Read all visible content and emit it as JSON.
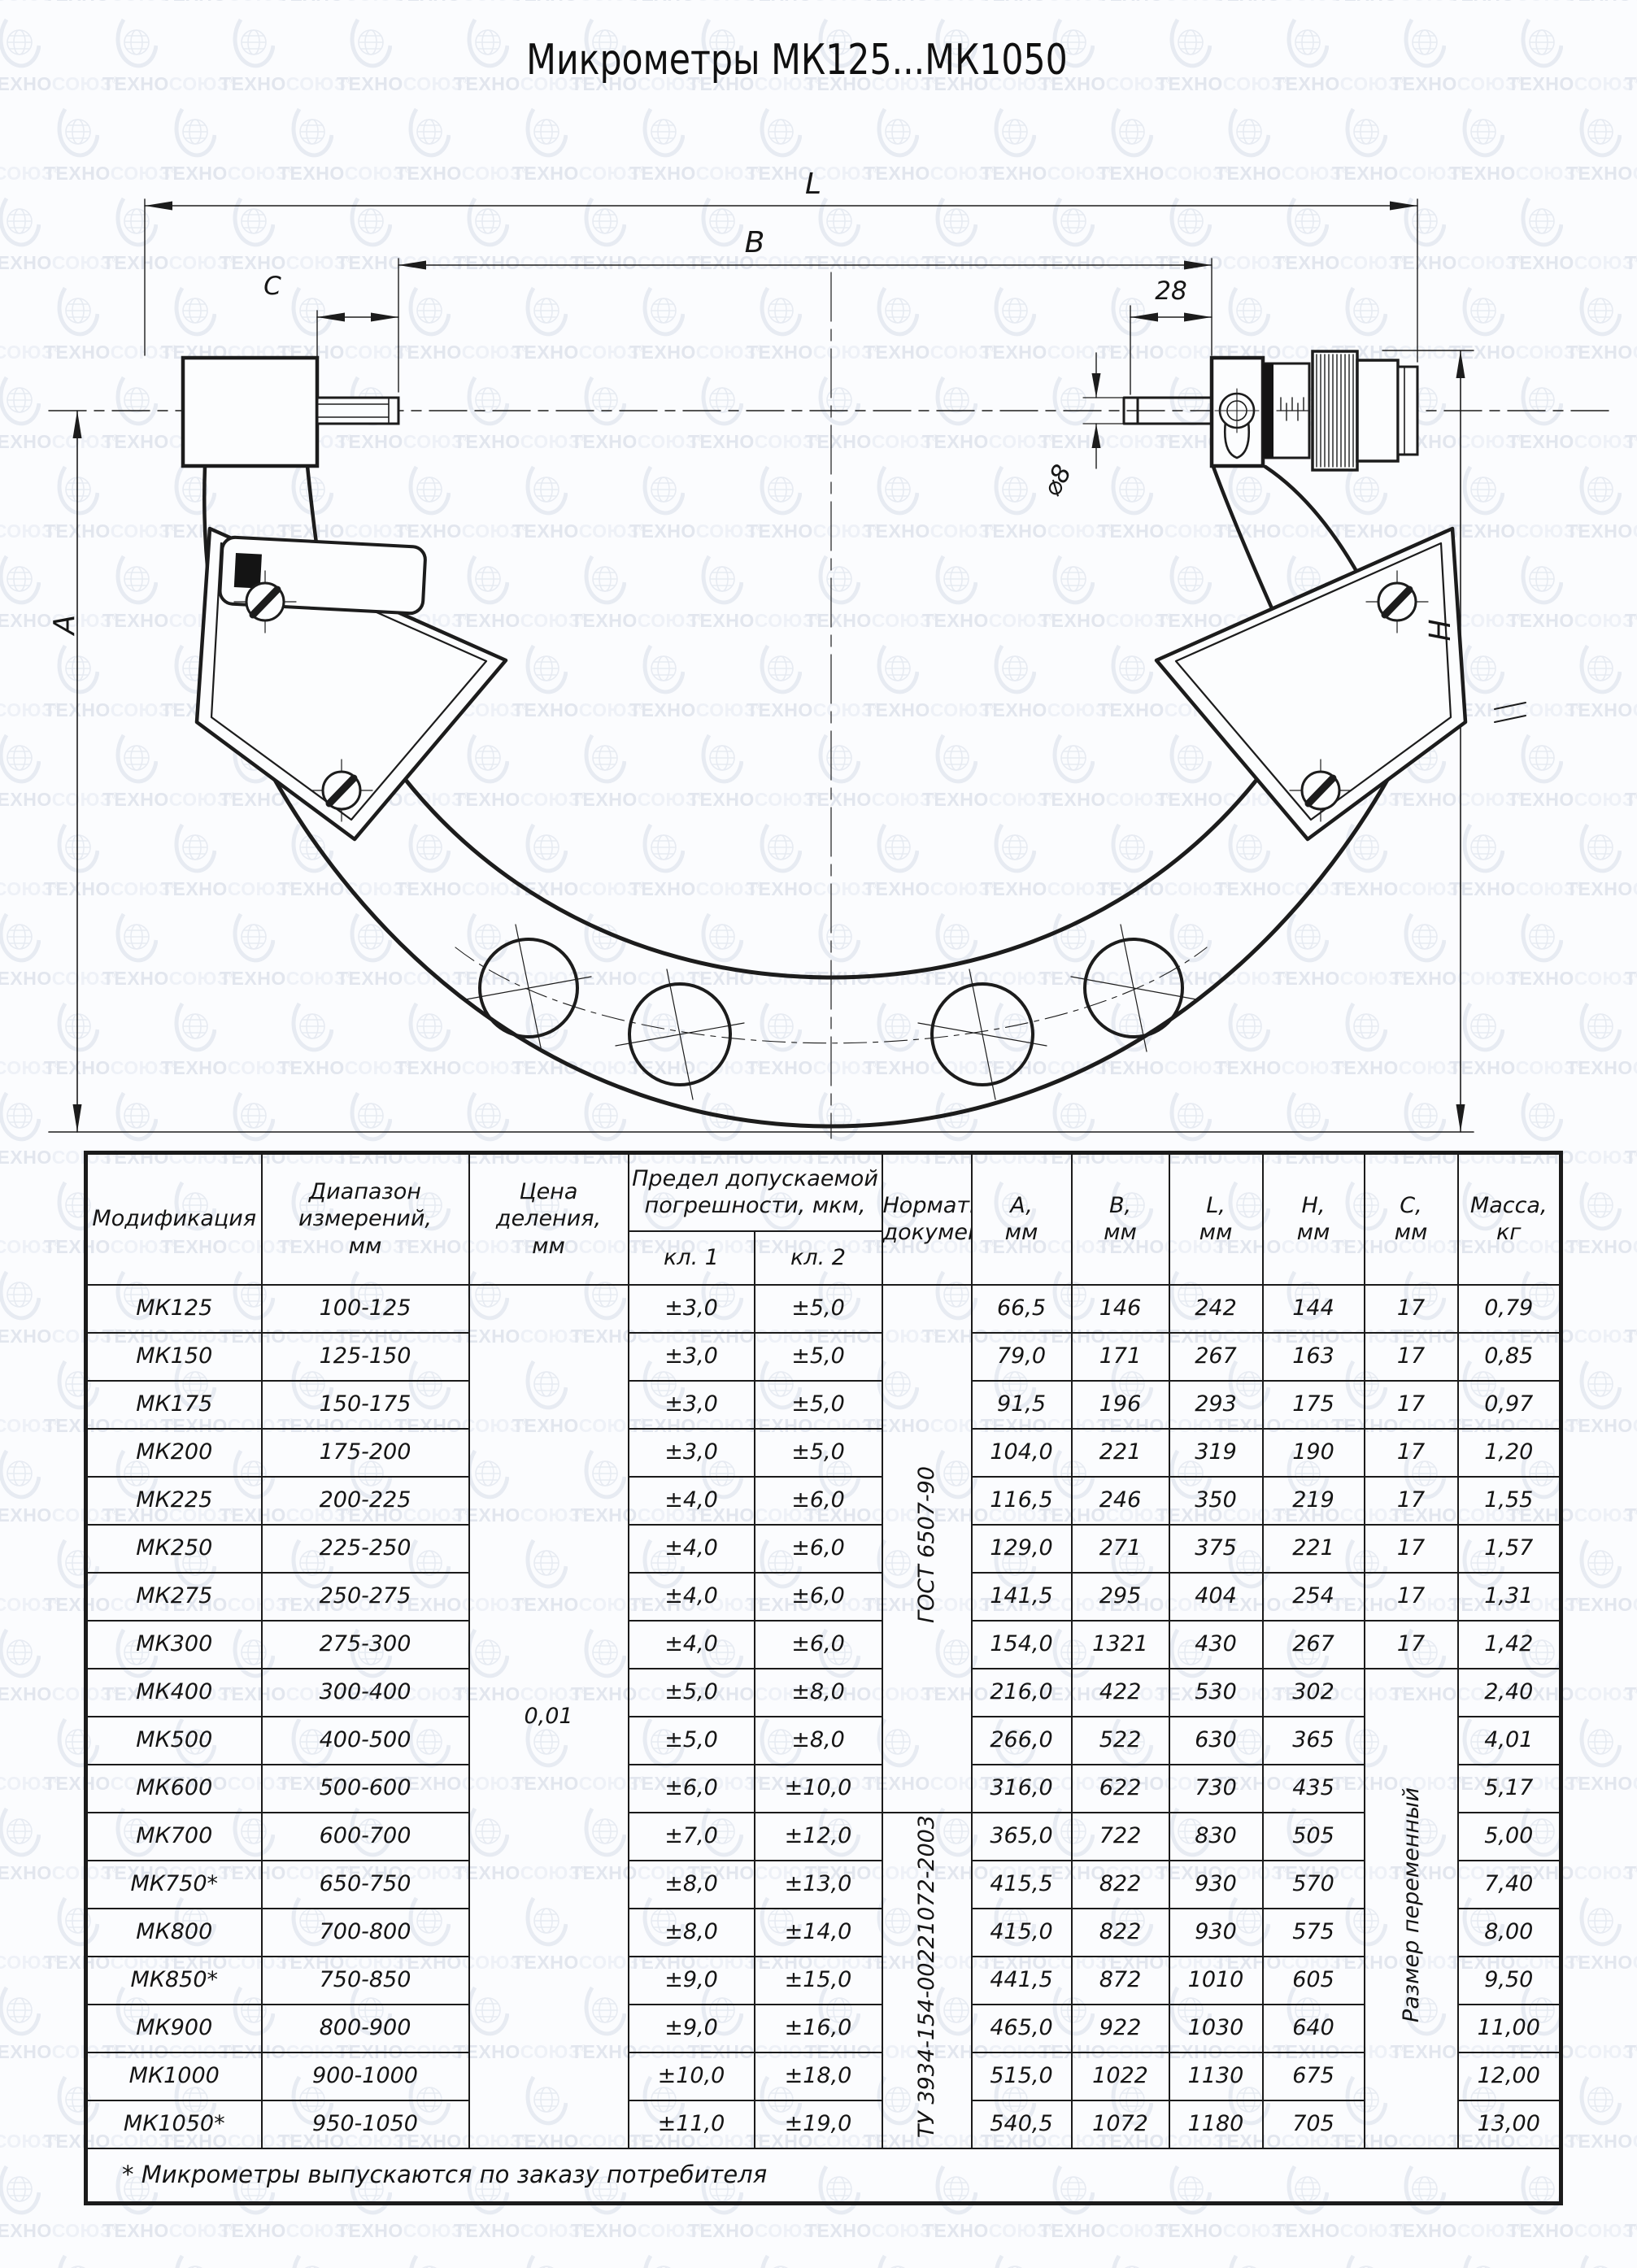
{
  "watermark": {
    "brand_part1": "ТЕХНО",
    "brand_part2": "СОЮЗ",
    "reg": "®"
  },
  "title": "Микрометры МК125...МК1050",
  "drawing": {
    "dim_labels": {
      "l": "L",
      "b": "B",
      "c": "C",
      "s28": "28",
      "d8": "⌀8",
      "a": "A",
      "h": "H"
    }
  },
  "table": {
    "headers": {
      "model": "Модификация",
      "range": "Диапазон\nизмерений,\nмм",
      "division": "Цена\nделения,\nмм",
      "error_limit": "Предел допускаемой\nпогрешности, мкм,",
      "cl1": "кл. 1",
      "cl2": "кл. 2",
      "doc": "Нормативный\nдокумент",
      "a": "A,\nмм",
      "b": "B,\nмм",
      "l": "L,\nмм",
      "h": "H,\nмм",
      "c": "C,\nмм",
      "mass": "Масса,\nкг"
    },
    "merged": {
      "division_value": "0,01",
      "doc_gost": "ГОСТ 6507-90",
      "doc_tu": "ТУ 3934-154-00221072-2003",
      "c_variable": "Размер переменный"
    },
    "rows": [
      {
        "model": "МК125",
        "range": "100-125",
        "cl1": "±3,0",
        "cl2": "±5,0",
        "a": "66,5",
        "b": "146",
        "l": "242",
        "h": "144",
        "c": "17",
        "mass": "0,79"
      },
      {
        "model": "МК150",
        "range": "125-150",
        "cl1": "±3,0",
        "cl2": "±5,0",
        "a": "79,0",
        "b": "171",
        "l": "267",
        "h": "163",
        "c": "17",
        "mass": "0,85"
      },
      {
        "model": "МК175",
        "range": "150-175",
        "cl1": "±3,0",
        "cl2": "±5,0",
        "a": "91,5",
        "b": "196",
        "l": "293",
        "h": "175",
        "c": "17",
        "mass": "0,97"
      },
      {
        "model": "МК200",
        "range": "175-200",
        "cl1": "±3,0",
        "cl2": "±5,0",
        "a": "104,0",
        "b": "221",
        "l": "319",
        "h": "190",
        "c": "17",
        "mass": "1,20"
      },
      {
        "model": "МК225",
        "range": "200-225",
        "cl1": "±4,0",
        "cl2": "±6,0",
        "a": "116,5",
        "b": "246",
        "l": "350",
        "h": "219",
        "c": "17",
        "mass": "1,55"
      },
      {
        "model": "МК250",
        "range": "225-250",
        "cl1": "±4,0",
        "cl2": "±6,0",
        "a": "129,0",
        "b": "271",
        "l": "375",
        "h": "221",
        "c": "17",
        "mass": "1,57"
      },
      {
        "model": "МК275",
        "range": "250-275",
        "cl1": "±4,0",
        "cl2": "±6,0",
        "a": "141,5",
        "b": "295",
        "l": "404",
        "h": "254",
        "c": "17",
        "mass": "1,31"
      },
      {
        "model": "МК300",
        "range": "275-300",
        "cl1": "±4,0",
        "cl2": "±6,0",
        "a": "154,0",
        "b": "1321",
        "l": "430",
        "h": "267",
        "c": "17",
        "mass": "1,42"
      },
      {
        "model": "МК400",
        "range": "300-400",
        "cl1": "±5,0",
        "cl2": "±8,0",
        "a": "216,0",
        "b": "422",
        "l": "530",
        "h": "302",
        "c": null,
        "mass": "2,40"
      },
      {
        "model": "МК500",
        "range": "400-500",
        "cl1": "±5,0",
        "cl2": "±8,0",
        "a": "266,0",
        "b": "522",
        "l": "630",
        "h": "365",
        "c": null,
        "mass": "4,01"
      },
      {
        "model": "МК600",
        "range": "500-600",
        "cl1": "±6,0",
        "cl2": "±10,0",
        "a": "316,0",
        "b": "622",
        "l": "730",
        "h": "435",
        "c": null,
        "mass": "5,17"
      },
      {
        "model": "МК700",
        "range": "600-700",
        "cl1": "±7,0",
        "cl2": "±12,0",
        "a": "365,0",
        "b": "722",
        "l": "830",
        "h": "505",
        "c": null,
        "mass": "5,00"
      },
      {
        "model": "МК750*",
        "range": "650-750",
        "cl1": "±8,0",
        "cl2": "±13,0",
        "a": "415,5",
        "b": "822",
        "l": "930",
        "h": "570",
        "c": null,
        "mass": "7,40"
      },
      {
        "model": "МК800",
        "range": "700-800",
        "cl1": "±8,0",
        "cl2": "±14,0",
        "a": "415,0",
        "b": "822",
        "l": "930",
        "h": "575",
        "c": null,
        "mass": "8,00"
      },
      {
        "model": "МК850*",
        "range": "750-850",
        "cl1": "±9,0",
        "cl2": "±15,0",
        "a": "441,5",
        "b": "872",
        "l": "1010",
        "h": "605",
        "c": null,
        "mass": "9,50"
      },
      {
        "model": "МК900",
        "range": "800-900",
        "cl1": "±9,0",
        "cl2": "±16,0",
        "a": "465,0",
        "b": "922",
        "l": "1030",
        "h": "640",
        "c": null,
        "mass": "11,00"
      },
      {
        "model": "МК1000",
        "range": "900-1000",
        "cl1": "±10,0",
        "cl2": "±18,0",
        "a": "515,0",
        "b": "1022",
        "l": "1130",
        "h": "675",
        "c": null,
        "mass": "12,00"
      },
      {
        "model": "МК1050*",
        "range": "950-1050",
        "cl1": "±11,0",
        "cl2": "±19,0",
        "a": "540,5",
        "b": "1072",
        "l": "1180",
        "h": "705",
        "c": null,
        "mass": "13,00"
      }
    ],
    "footnote": "* Микрометры выпускаются по заказу потребителя"
  }
}
